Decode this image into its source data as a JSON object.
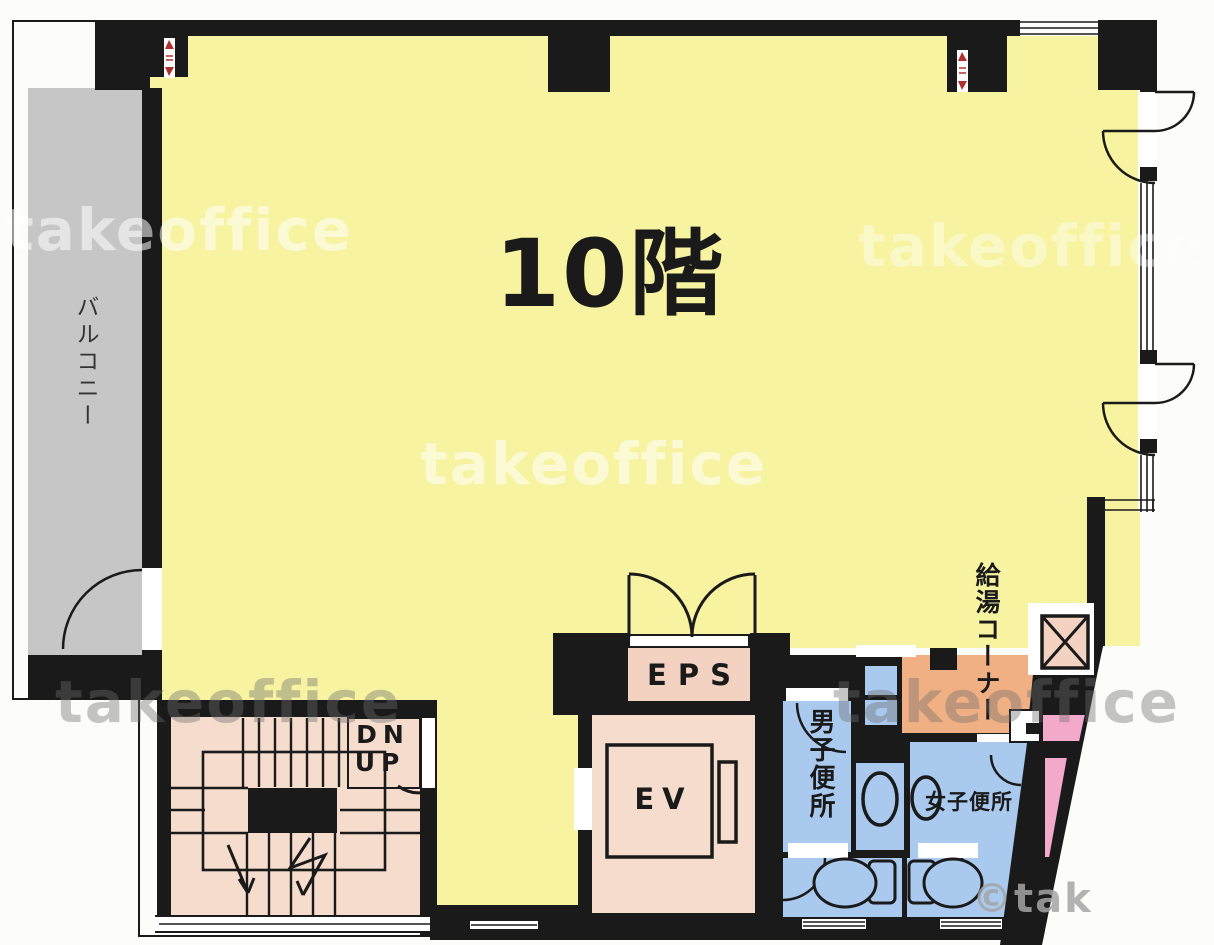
{
  "plan": {
    "floor_label": "10階",
    "balcony": {
      "label": "バルコニー"
    },
    "stairwell": {
      "dn_label": "DN",
      "up_label": "UP"
    },
    "eps": {
      "label": "EPS"
    },
    "elevator": {
      "label": "EV"
    },
    "mens_toilet": {
      "label": "男子便所"
    },
    "womens_toilet": {
      "label": "女子便所"
    },
    "kitchenette": {
      "label": "給湯コーナー"
    },
    "watermark": {
      "text": "takeoffice",
      "copyright": "©tak"
    },
    "colors": {
      "office_yellow": "#f7f3a0",
      "balcony_gray": "#c6c6c6",
      "service_beige": "#f5dccd",
      "eps_beige": "#f3d2c2",
      "toilet_blue": "#a9c9ef",
      "kitchenette_orange": "#f0b083",
      "accent_pink": "#f3a9ca",
      "wall_black": "#1a1a1a"
    }
  }
}
